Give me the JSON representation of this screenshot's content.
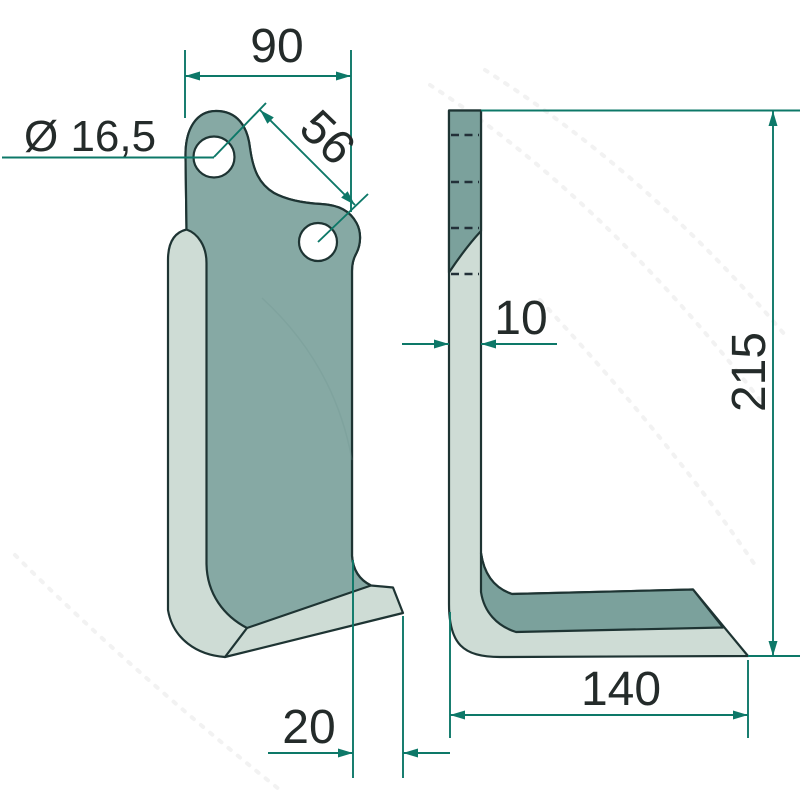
{
  "dims": {
    "top_width": {
      "label": "90"
    },
    "hole_diameter": {
      "label": "Ø 16,5"
    },
    "hole_spacing": {
      "label": "56"
    },
    "thickness": {
      "label": "10"
    },
    "height": {
      "label": "215"
    },
    "foot_length": {
      "label": "140"
    },
    "lip_offset": {
      "label": "20"
    }
  },
  "colors": {
    "face_dark": "#86a9a4",
    "side_dark": "#7ba19c",
    "edge_light": "#cedcd5",
    "hole_white": "#ffffff",
    "outline": "#1e3433",
    "dimension": "#0d7868",
    "label_text": "#242b2a",
    "background": "#ffffff"
  }
}
